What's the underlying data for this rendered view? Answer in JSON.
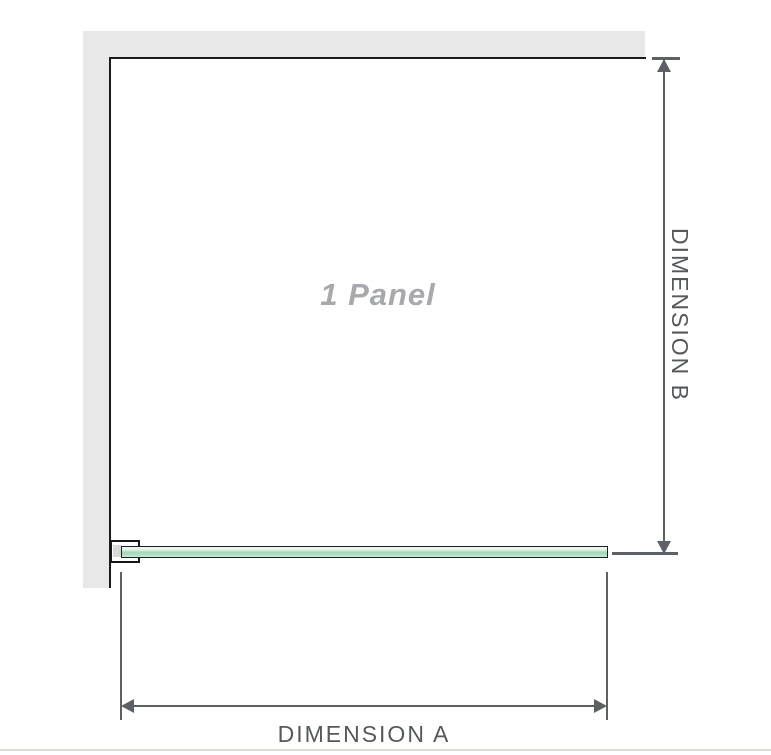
{
  "diagram": {
    "type": "shower-screen-dimension-diagram",
    "panel_label": "1 Panel",
    "dimension_a": {
      "label": "DIMENSION A",
      "orientation": "horizontal",
      "measures": "glass panel width"
    },
    "dimension_b": {
      "label": "DIMENSION B",
      "orientation": "vertical",
      "measures": "panel height"
    },
    "colors": {
      "wall_fill": "#e8e8e8",
      "panel_outline": "#1b1b1b",
      "dimension_lines": "#5d6064",
      "dimension_text": "#56595c",
      "panel_label_text": "#a7a9ac",
      "glass_green_light": "#e3f2e9",
      "glass_green_mid": "#a6d8b9",
      "glass_border": "#1f1f1f",
      "bracket_outline": "#171717",
      "bottom_rule": "#dcdcd6"
    }
  }
}
